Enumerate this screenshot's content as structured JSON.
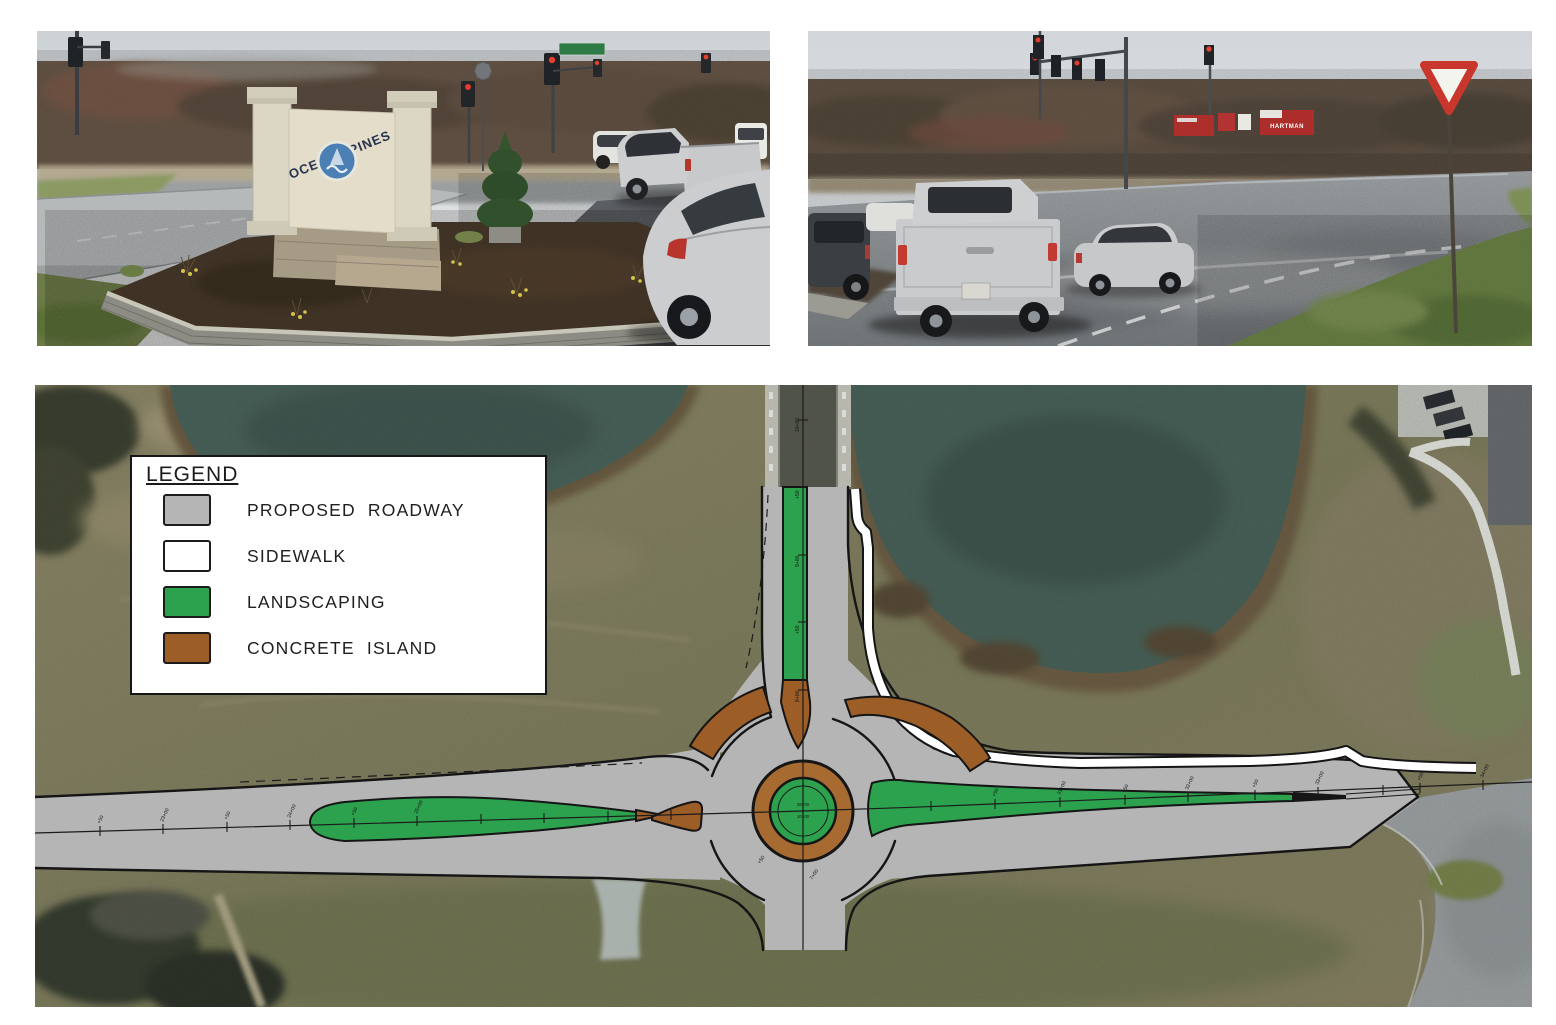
{
  "legend": {
    "title": "LEGEND",
    "items": [
      {
        "label": "PROPOSED  ROADWAY",
        "color": "#b5b5b5"
      },
      {
        "label": "SIDEWALK",
        "color": "#ffffff"
      },
      {
        "label": "LANDSCAPING",
        "color": "#2ca24e"
      },
      {
        "label": "CONCRETE  ISLAND",
        "color": "#9d5d27"
      }
    ]
  },
  "photos": {
    "left": {
      "sign_word_top": "OCEAN",
      "sign_word_bottom": "PINES"
    },
    "right": {
      "campaign_sign_text": "HARTMAN"
    }
  },
  "plan": {
    "colors": {
      "proposed_roadway": "#b5b5b5",
      "sidewalk": "#ffffff",
      "landscaping": "#2ca24e",
      "concrete_island": "#9d5d27",
      "truck_apron": "#a76a31"
    },
    "stations": {
      "ew": [
        "+50",
        "23+00",
        "+50",
        "24+00",
        "+50",
        "25+00",
        "+50",
        "31+00",
        "+50",
        "32+00",
        "+50",
        "33+00",
        "+50",
        "34+00"
      ],
      "ns": [
        "10+00",
        "+50",
        "9+00",
        "+50",
        "8+00",
        "+50",
        "7+00"
      ],
      "center_note": [
        "28+00",
        "=",
        "10+00"
      ]
    }
  }
}
